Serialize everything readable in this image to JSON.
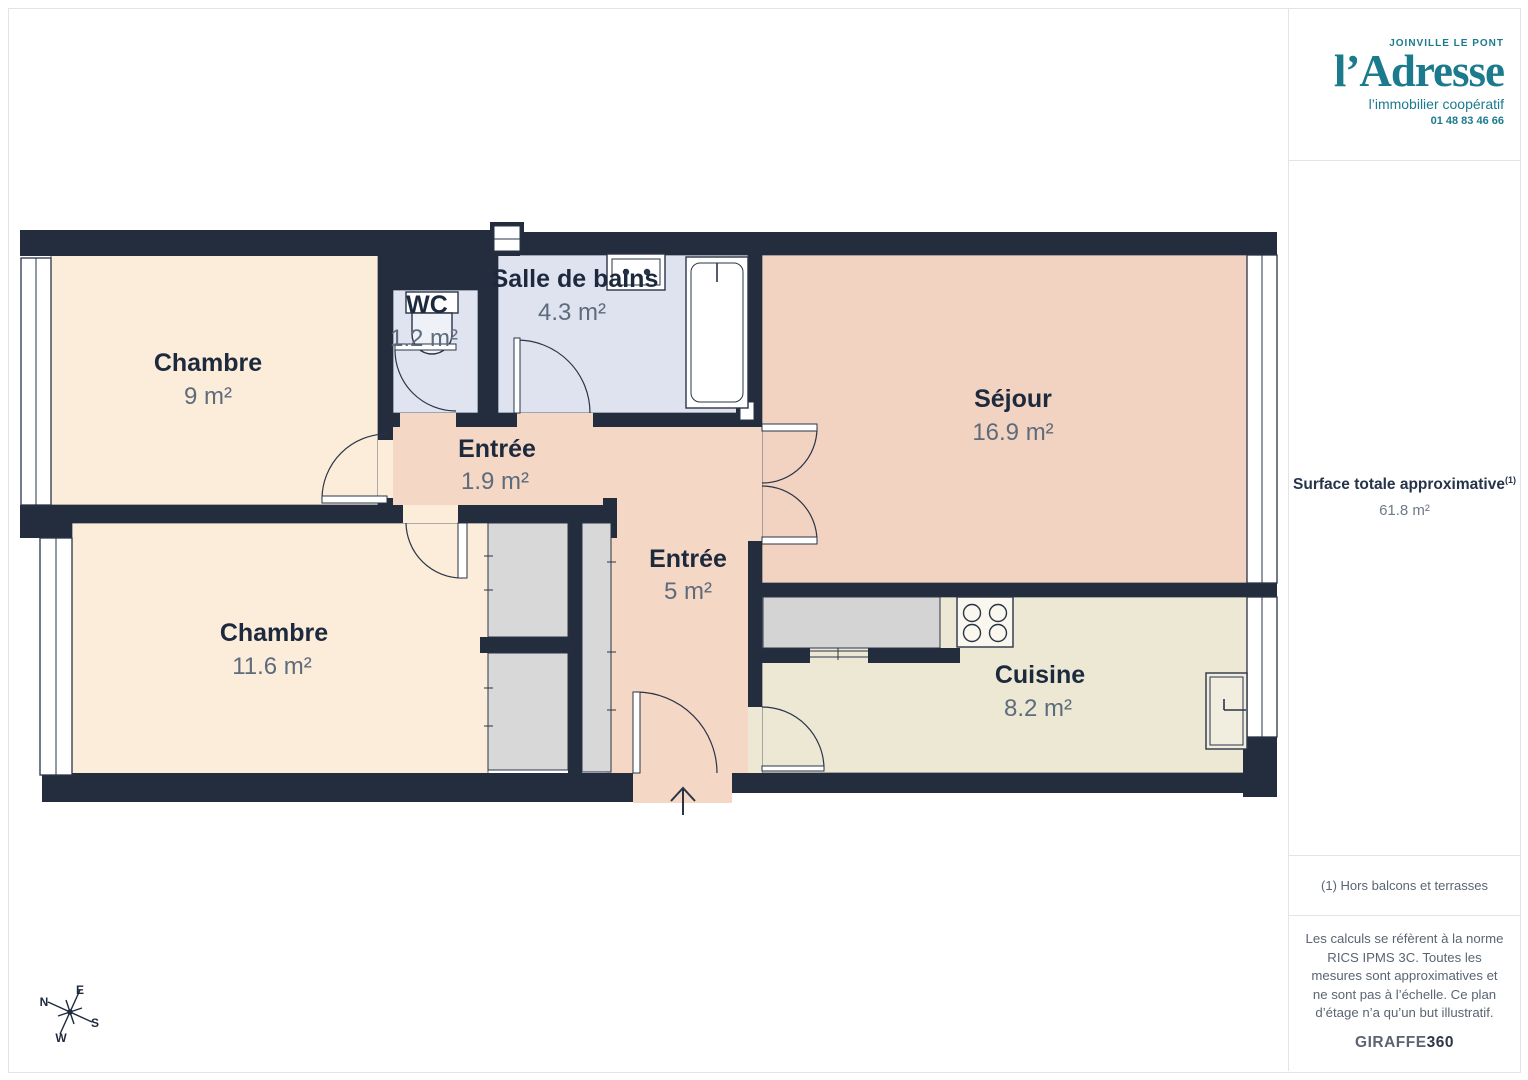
{
  "colors": {
    "wall": "#232d3e",
    "bedroom": "#fcecda",
    "entry": "#f4d7c5",
    "living": "#f2d3c1",
    "bathroom": "#dfe3f0",
    "wc": "#e0e4f0",
    "kitchen": "#ece8d4",
    "storage": "#d8d8d8",
    "counter": "#d4d4d4",
    "fixture": "#ffffff",
    "outline": "#2a3447",
    "brand_teal": "#1b7b8d"
  },
  "floorplan": {
    "rooms": [
      {
        "id": "chambre-9",
        "name": "Chambre",
        "area": "9 m²"
      },
      {
        "id": "wc",
        "name": "WC",
        "area": "1.2 m²"
      },
      {
        "id": "salle-de-bains",
        "name": "Salle de bains",
        "area": "4.3 m²"
      },
      {
        "id": "sejour",
        "name": "Séjour",
        "area": "16.9 m²"
      },
      {
        "id": "entree-1",
        "name": "Entrée",
        "area": "1.9 m²"
      },
      {
        "id": "entree-2",
        "name": "Entrée",
        "area": "5 m²"
      },
      {
        "id": "chambre-11",
        "name": "Chambre",
        "area": "11.6 m²"
      },
      {
        "id": "cuisine",
        "name": "Cuisine",
        "area": "8.2 m²"
      }
    ],
    "compass": {
      "n": "N",
      "e": "E",
      "s": "S",
      "w": "W"
    }
  },
  "sidebar": {
    "logo": {
      "city": "JOINVILLE LE PONT",
      "brand": "l’Adresse",
      "tagline": "l’immobilier coopératif",
      "phone": "01 48 83 46 66"
    },
    "surface": {
      "label": "Surface totale approximative",
      "sup": "(1)",
      "value": "61.8 m²"
    },
    "footnote": "(1) Hors balcons et terrasses",
    "disclaimer": "Les calculs se réfèrent à la norme RICS IPMS 3C. Toutes les mesures sont approximatives et ne sont pas à l’échelle. Ce plan d’étage n’a qu’un but illustratif.",
    "brand_footer": {
      "name": "GIRAFFE",
      "suffix": "360"
    }
  }
}
